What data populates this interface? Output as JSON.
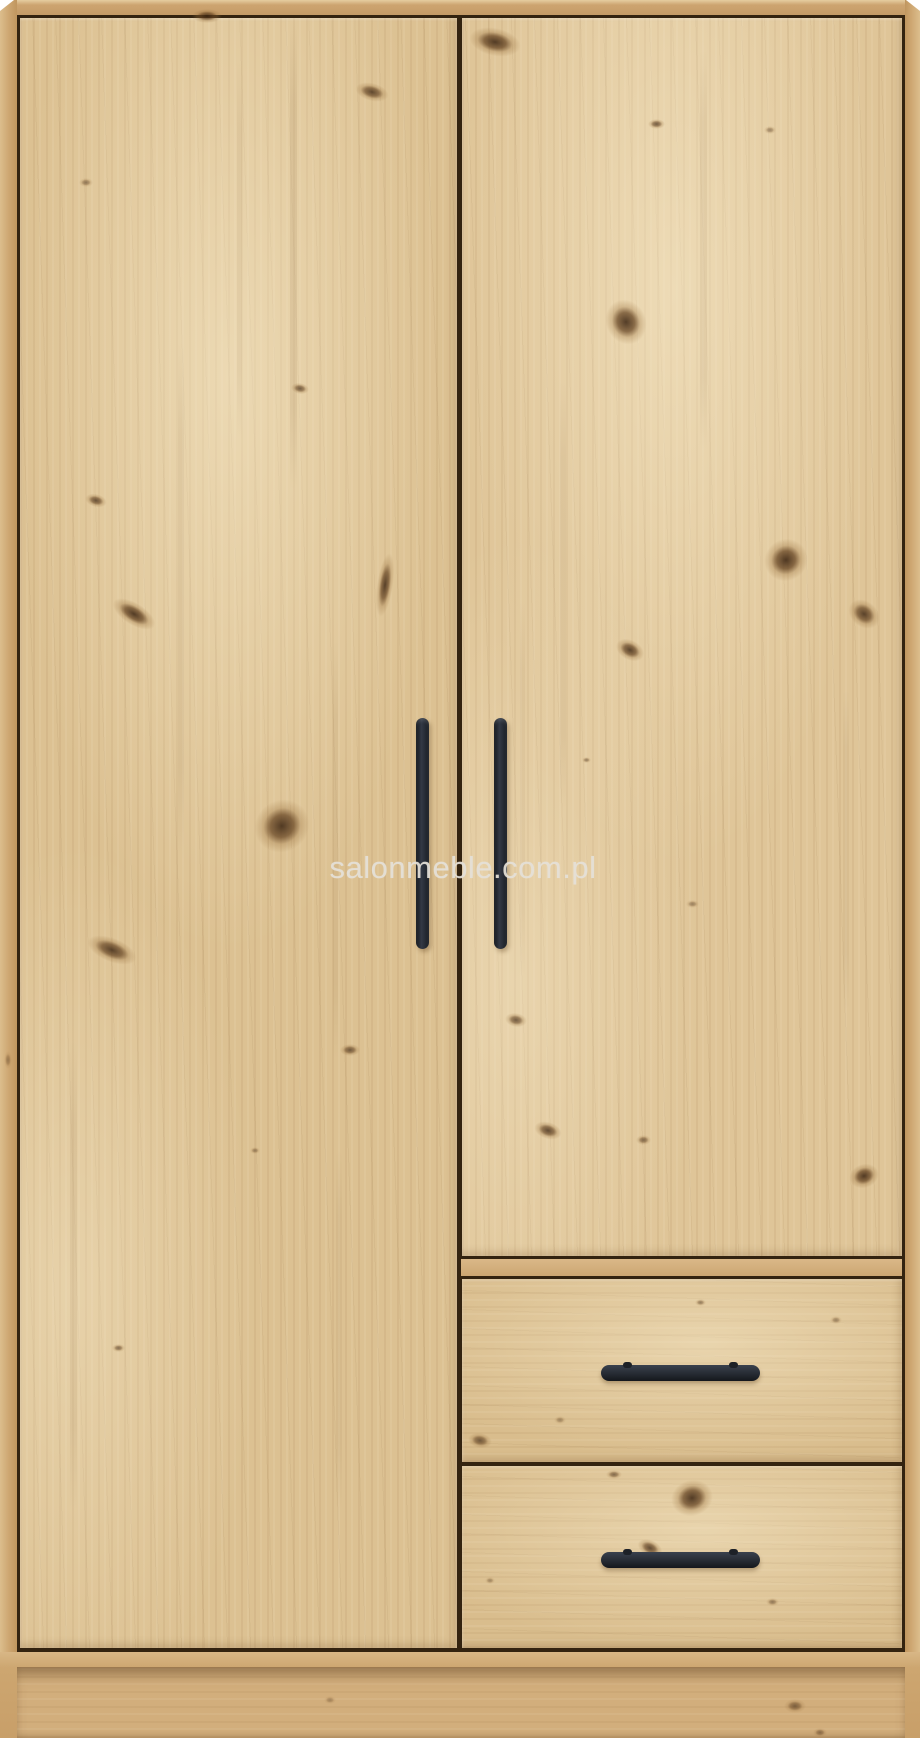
{
  "page": {
    "background": "#ffffff",
    "subject": "Two-door wardrobe with two bottom drawers, artisan oak finish, black metal handles, front view product photo"
  },
  "watermark": {
    "text": "salonmeble.com.pl",
    "color": "rgba(228,224,215,0.92)"
  },
  "wardrobe": {
    "parts": {
      "left_door": "left door",
      "right_door": "right door",
      "drawer_top": "top drawer",
      "drawer_bottom": "bottom drawer",
      "plinth": "base plinth"
    },
    "colors": {
      "frame": "#cda671",
      "door": "#dcc192",
      "drawer": "#d9bd8d",
      "plinth_recess": "#d2ae7c",
      "seam_line": "#332310",
      "handle": "#262b33"
    }
  },
  "texture": {
    "knots": [
      {
        "x": 207,
        "y": 16,
        "w": 30,
        "h": 14,
        "r": 0,
        "o": 0.85
      },
      {
        "x": 372,
        "y": 92,
        "w": 34,
        "h": 18,
        "r": 15,
        "o": 0.8
      },
      {
        "x": 86,
        "y": 182,
        "w": 14,
        "h": 9,
        "r": 0,
        "o": 0.5
      },
      {
        "x": 300,
        "y": 388,
        "w": 18,
        "h": 11,
        "r": 10,
        "o": 0.7
      },
      {
        "x": 96,
        "y": 500,
        "w": 22,
        "h": 13,
        "r": 15,
        "o": 0.75
      },
      {
        "x": 134,
        "y": 614,
        "w": 48,
        "h": 22,
        "r": 32,
        "o": 0.9
      },
      {
        "x": 385,
        "y": 585,
        "w": 16,
        "h": 64,
        "r": 8,
        "o": 0.85
      },
      {
        "x": 282,
        "y": 826,
        "w": 52,
        "h": 56,
        "r": 55,
        "o": 0.9
      },
      {
        "x": 112,
        "y": 950,
        "w": 52,
        "h": 24,
        "r": 22,
        "o": 0.85
      },
      {
        "x": 350,
        "y": 1050,
        "w": 20,
        "h": 12,
        "r": 0,
        "o": 0.7
      },
      {
        "x": 118,
        "y": 1348,
        "w": 13,
        "h": 8,
        "r": 0,
        "o": 0.6
      },
      {
        "x": 255,
        "y": 1150,
        "w": 10,
        "h": 7,
        "r": 0,
        "o": 0.45
      },
      {
        "x": 495,
        "y": 42,
        "w": 52,
        "h": 28,
        "r": 12,
        "o": 0.9
      },
      {
        "x": 656,
        "y": 124,
        "w": 17,
        "h": 10,
        "r": 0,
        "o": 0.7
      },
      {
        "x": 626,
        "y": 322,
        "w": 46,
        "h": 40,
        "r": 65,
        "o": 0.9
      },
      {
        "x": 786,
        "y": 560,
        "w": 42,
        "h": 44,
        "r": 55,
        "o": 0.92
      },
      {
        "x": 630,
        "y": 650,
        "w": 30,
        "h": 20,
        "r": 28,
        "o": 0.85
      },
      {
        "x": 864,
        "y": 614,
        "w": 34,
        "h": 26,
        "r": 40,
        "o": 0.85
      },
      {
        "x": 516,
        "y": 1020,
        "w": 22,
        "h": 14,
        "r": 10,
        "o": 0.7
      },
      {
        "x": 586,
        "y": 760,
        "w": 9,
        "h": 6,
        "r": 0,
        "o": 0.5
      },
      {
        "x": 692,
        "y": 904,
        "w": 13,
        "h": 8,
        "r": 0,
        "o": 0.45
      },
      {
        "x": 770,
        "y": 130,
        "w": 12,
        "h": 8,
        "r": 0,
        "o": 0.45
      },
      {
        "x": 548,
        "y": 1130,
        "w": 28,
        "h": 17,
        "r": 18,
        "o": 0.8
      },
      {
        "x": 643,
        "y": 1140,
        "w": 15,
        "h": 10,
        "r": 0,
        "o": 0.6
      },
      {
        "x": 864,
        "y": 1176,
        "w": 24,
        "h": 30,
        "r": 70,
        "o": 0.9
      },
      {
        "x": 480,
        "y": 1440,
        "w": 24,
        "h": 15,
        "r": 10,
        "o": 0.7
      },
      {
        "x": 700,
        "y": 1302,
        "w": 11,
        "h": 7,
        "r": 0,
        "o": 0.5
      },
      {
        "x": 836,
        "y": 1320,
        "w": 12,
        "h": 8,
        "r": 0,
        "o": 0.45
      },
      {
        "x": 560,
        "y": 1420,
        "w": 12,
        "h": 8,
        "r": 0,
        "o": 0.4
      },
      {
        "x": 692,
        "y": 1498,
        "w": 36,
        "h": 42,
        "r": 75,
        "o": 0.9
      },
      {
        "x": 650,
        "y": 1548,
        "w": 26,
        "h": 16,
        "r": 25,
        "o": 0.8
      },
      {
        "x": 614,
        "y": 1474,
        "w": 16,
        "h": 9,
        "r": 0,
        "o": 0.6
      },
      {
        "x": 772,
        "y": 1602,
        "w": 13,
        "h": 8,
        "r": 0,
        "o": 0.5
      },
      {
        "x": 490,
        "y": 1580,
        "w": 10,
        "h": 7,
        "r": 0,
        "o": 0.4
      },
      {
        "x": 795,
        "y": 1706,
        "w": 22,
        "h": 14,
        "r": 0,
        "o": 0.6
      },
      {
        "x": 820,
        "y": 1732,
        "w": 14,
        "h": 9,
        "r": 0,
        "o": 0.5
      },
      {
        "x": 330,
        "y": 1700,
        "w": 12,
        "h": 8,
        "r": 0,
        "o": 0.35
      },
      {
        "x": 8,
        "y": 1060,
        "w": 8,
        "h": 18,
        "r": 0,
        "o": 0.4
      }
    ],
    "streaks": [
      {
        "x": 290,
        "y": 20,
        "w": 7,
        "h": 470,
        "o": 0.1
      },
      {
        "x": 178,
        "y": 340,
        "w": 6,
        "h": 520,
        "o": 0.08
      },
      {
        "x": 333,
        "y": 640,
        "w": 5,
        "h": 420,
        "o": 0.07
      },
      {
        "x": 70,
        "y": 1040,
        "w": 7,
        "h": 470,
        "o": 0.08
      },
      {
        "x": 336,
        "y": 1150,
        "w": 6,
        "h": 360,
        "o": 0.07
      },
      {
        "x": 237,
        "y": 60,
        "w": 5,
        "h": 380,
        "o": 0.07
      },
      {
        "x": 700,
        "y": 50,
        "w": 7,
        "h": 400,
        "o": 0.08
      },
      {
        "x": 560,
        "y": 380,
        "w": 6,
        "h": 430,
        "o": 0.07
      },
      {
        "x": 843,
        "y": 690,
        "w": 6,
        "h": 320,
        "o": 0.07
      },
      {
        "x": 520,
        "y": 600,
        "w": 5,
        "h": 380,
        "o": 0.06
      }
    ]
  }
}
